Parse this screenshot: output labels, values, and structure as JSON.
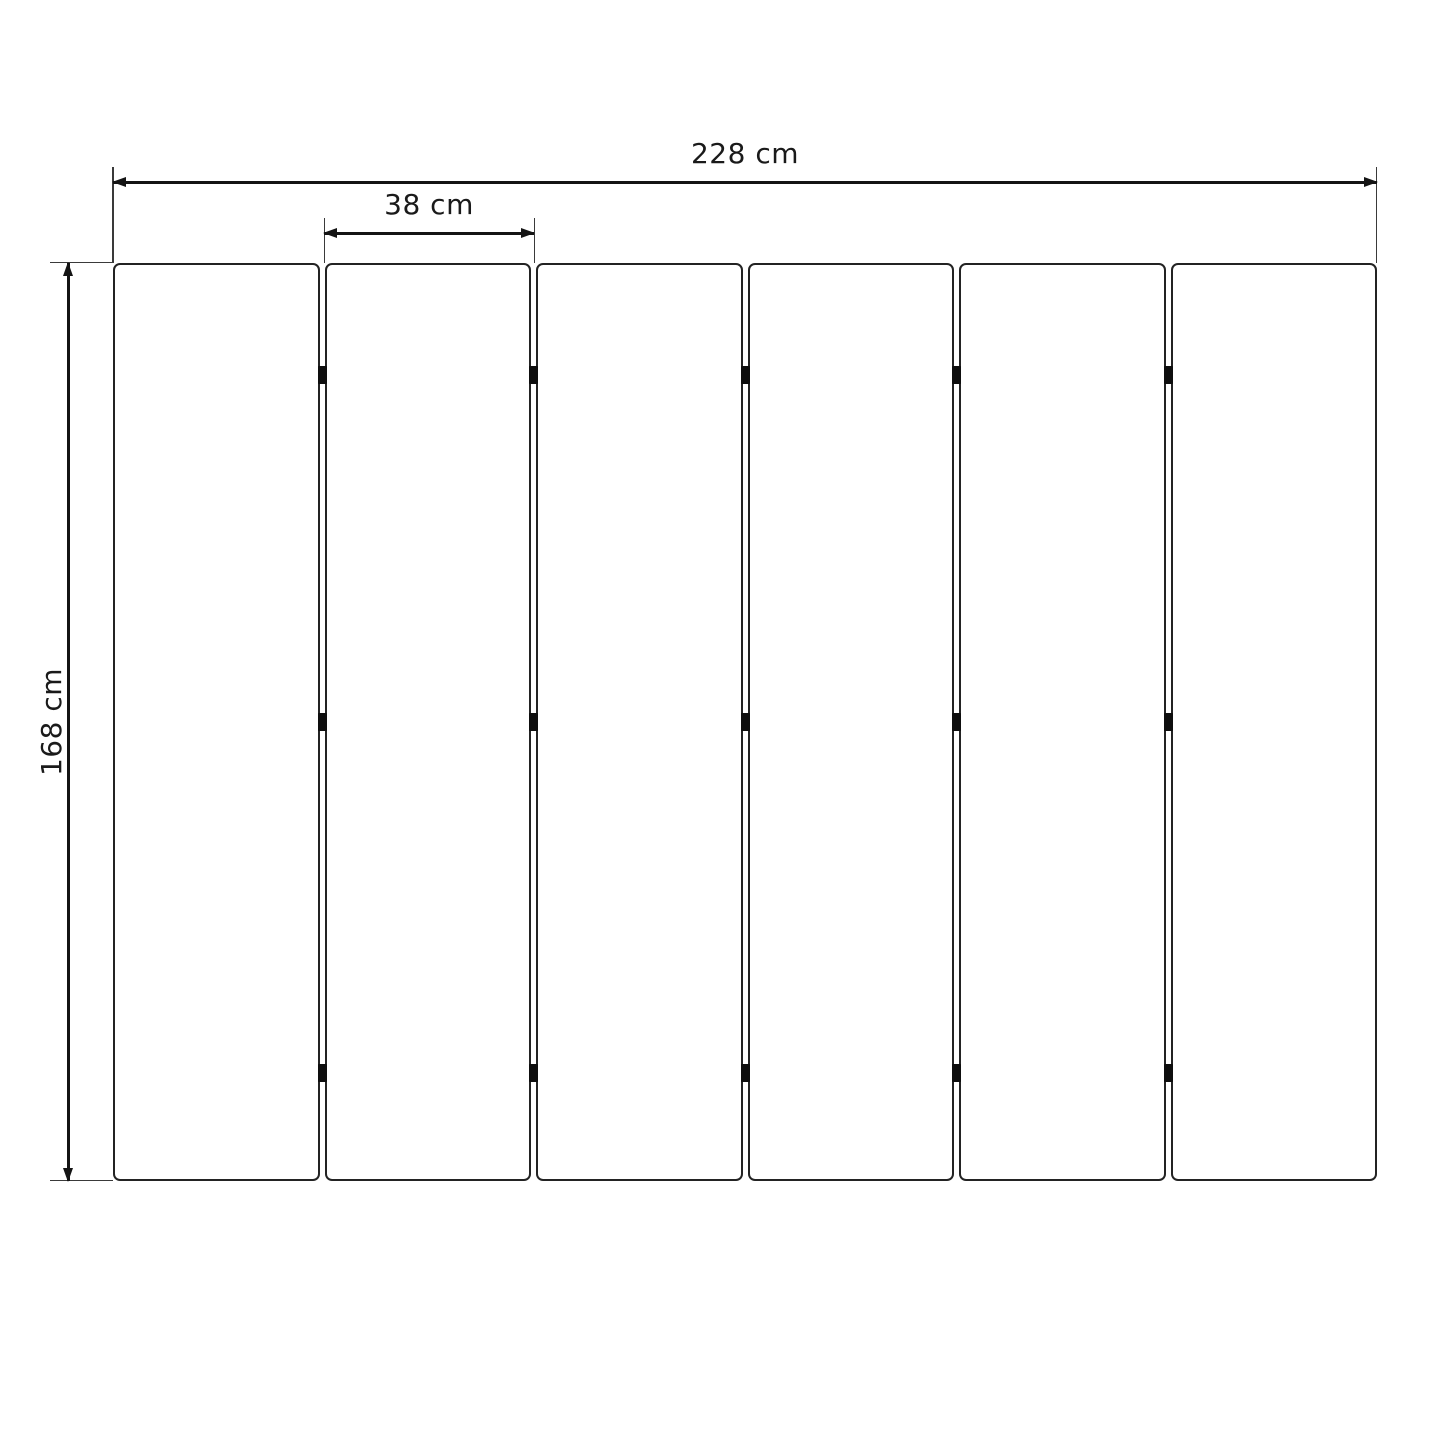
{
  "dimensions": {
    "total_width": {
      "label": "228 cm"
    },
    "panel_width": {
      "label": "38 cm"
    },
    "height": {
      "label": "168 cm"
    }
  },
  "structure": {
    "panel_count": 6,
    "joint_count": 5,
    "hinges_per_joint": 3
  },
  "colors": {
    "background": "#ffffff",
    "dimension_line": "#141414",
    "extension_line": "#3a3a3a",
    "panel_border": "#232323",
    "hinge": "#0e0e0e",
    "text": "#1a1a1a"
  }
}
